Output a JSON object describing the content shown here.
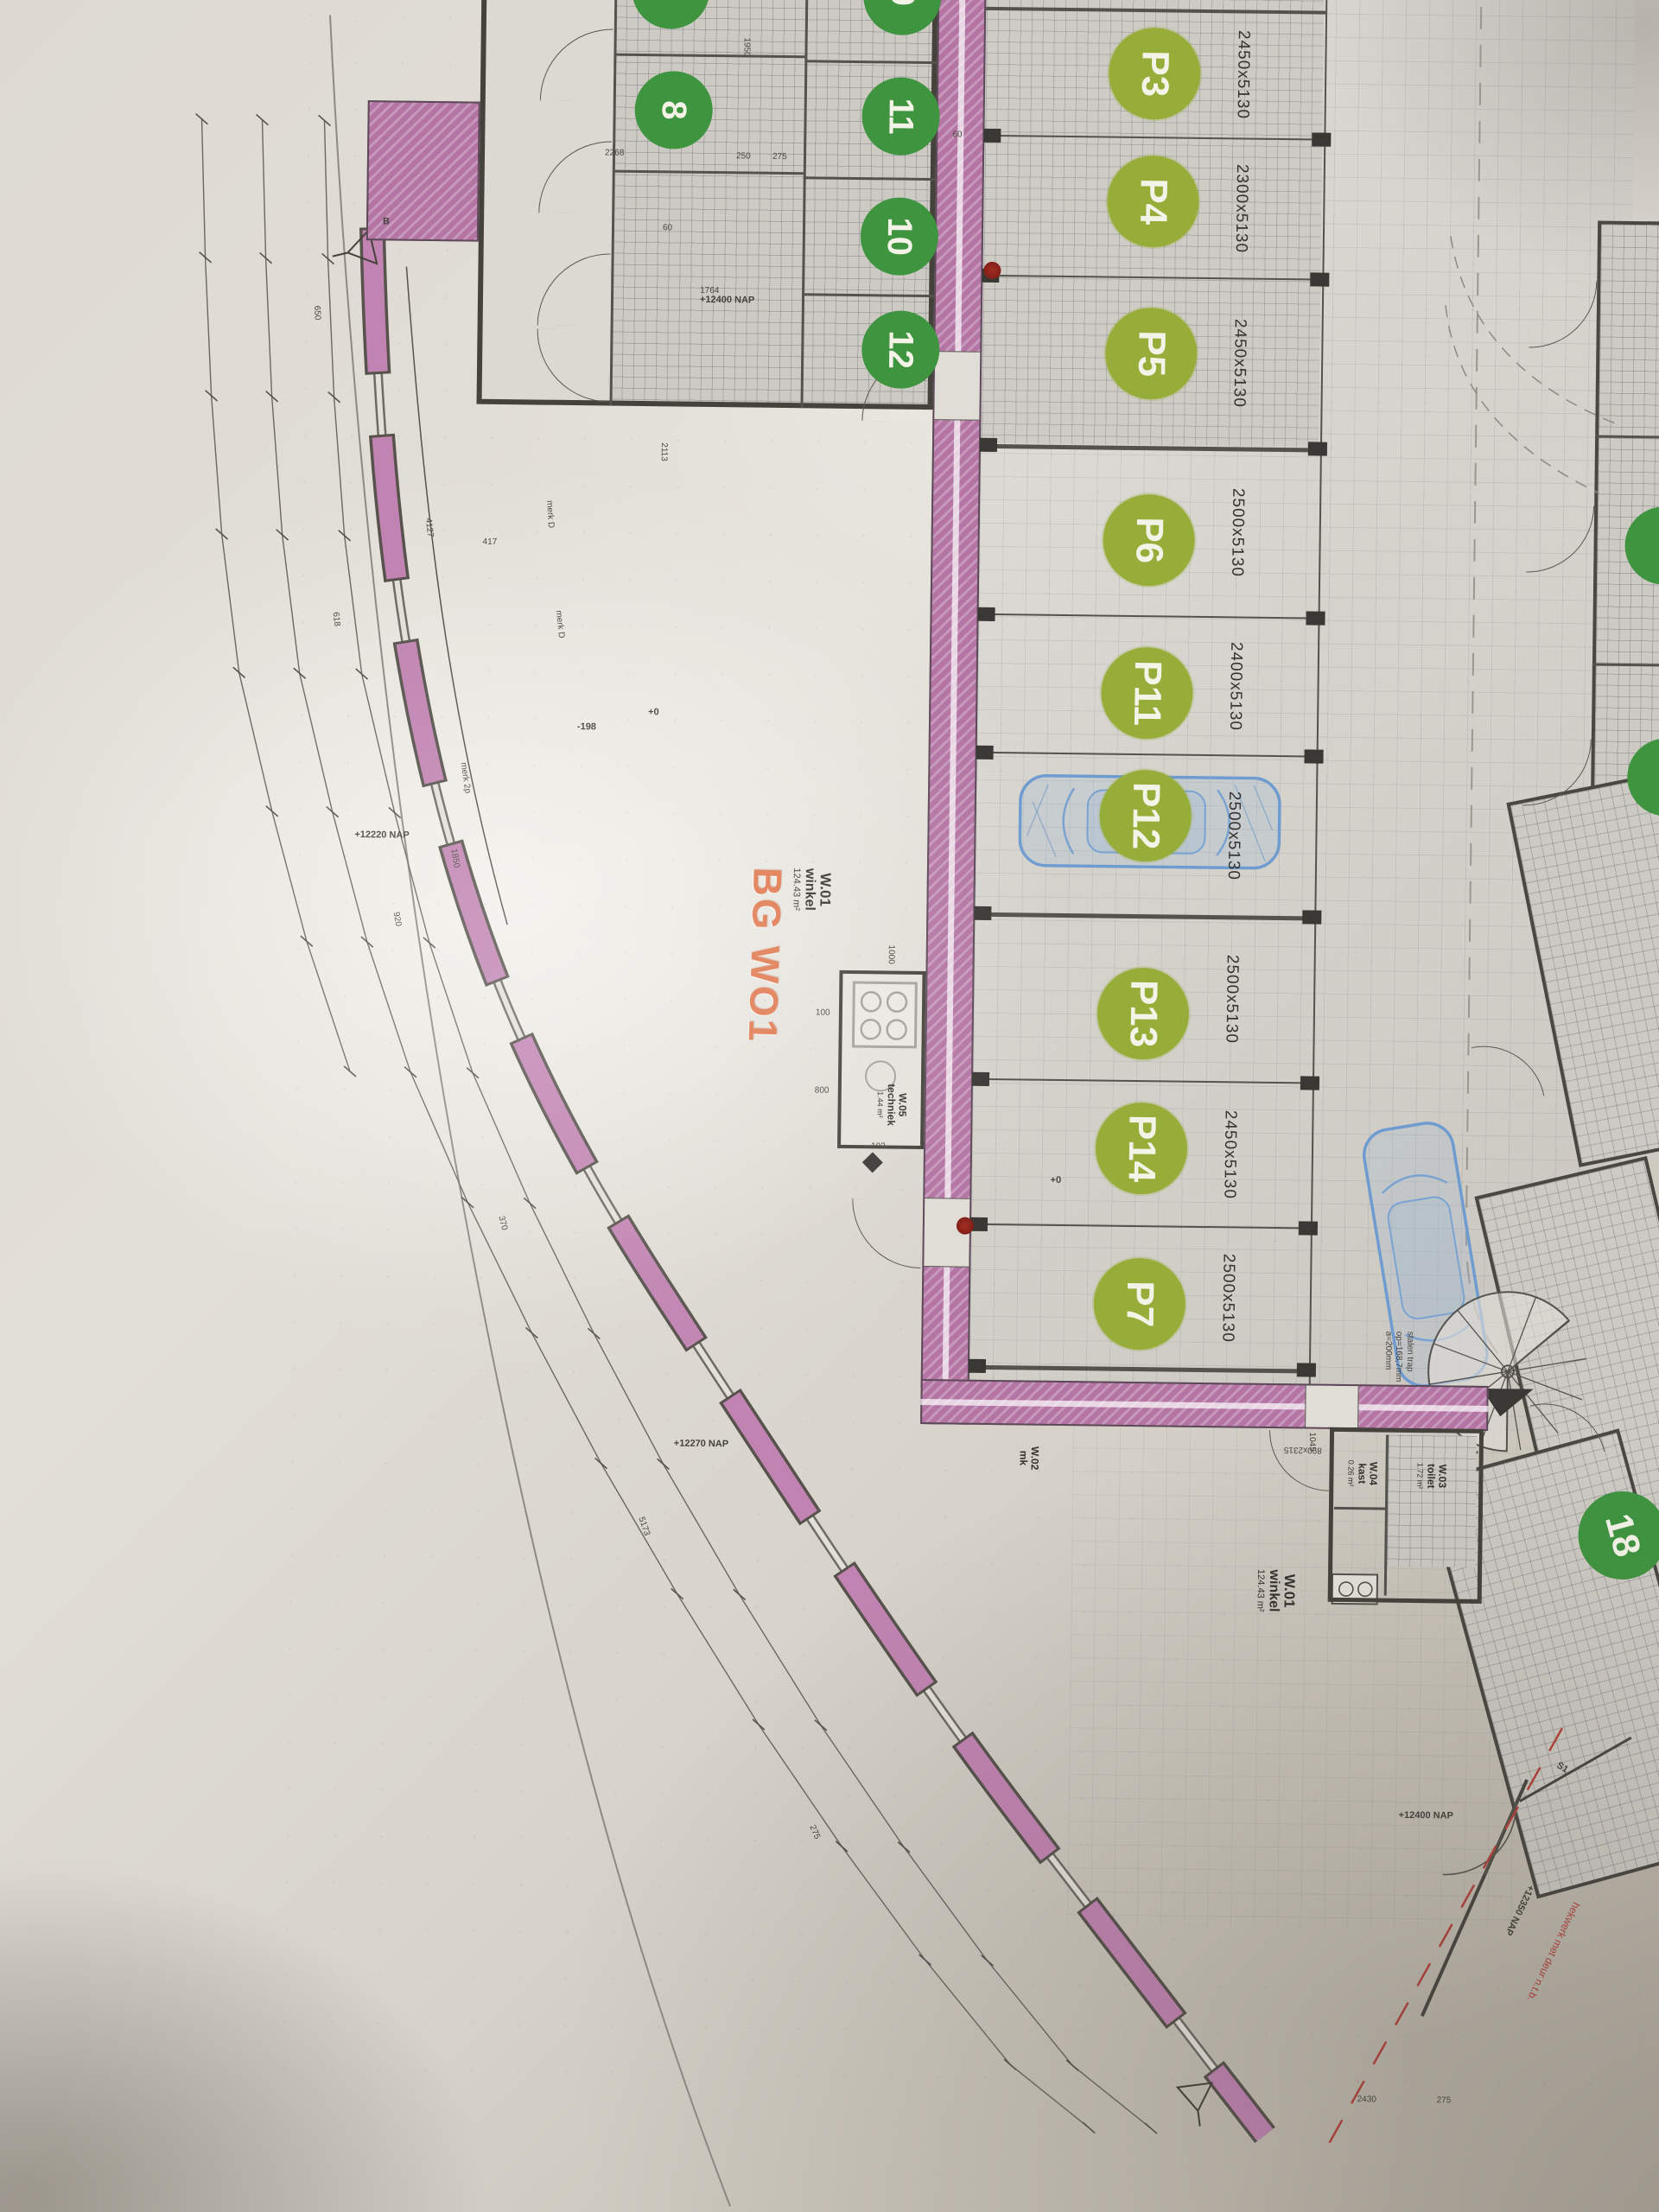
{
  "document": {
    "kind": "architectural floor plan photo",
    "stamp": "BG WO1"
  },
  "colors": {
    "parking_green": "#97ad39",
    "unit_green": "#3f9440",
    "wall_pink": "#b475a4",
    "stamp_orange": "#e0784e",
    "note_red": "#b5433c",
    "car_blue": "#7aa3d2"
  },
  "parking": {
    "spaces": [
      {
        "id": "P3",
        "size": "2450x5130"
      },
      {
        "id": "P4",
        "size": "2300x5130"
      },
      {
        "id": "P5",
        "size": "2450x5130"
      },
      {
        "id": "P6",
        "size": "2500x5130"
      },
      {
        "id": "P11",
        "size": "2400x5130"
      },
      {
        "id": "P12",
        "size": "2500x5130"
      },
      {
        "id": "P13",
        "size": "2500x5130"
      },
      {
        "id": "P14",
        "size": "2450x5130"
      },
      {
        "id": "P7",
        "size": "2500x5130"
      }
    ]
  },
  "units": {
    "numbers": [
      "9",
      "11",
      "10",
      "12",
      "7",
      "8",
      "18"
    ]
  },
  "rooms": {
    "winkel": {
      "id": "W.01",
      "name": "winkel",
      "area": "124.43 m²"
    },
    "techniek": {
      "id": "W.05",
      "name": "techniek",
      "area": "1.44 m²"
    },
    "toilet": {
      "id": "W.03",
      "name": "toilet",
      "area": "1.72 m²"
    },
    "kast": {
      "id": "W.04",
      "name": "kast",
      "area": "0.26 m²"
    },
    "mk": {
      "id": "W.02",
      "name": "mk"
    }
  },
  "levels": {
    "items": [
      {
        "text": "+12400 NAP"
      },
      {
        "text": "+12220 NAP"
      },
      {
        "text": "+12270 NAP"
      },
      {
        "text": "+12400 NAP"
      },
      {
        "text": "+12350 NAP"
      },
      {
        "text": "+0"
      },
      {
        "text": "-198"
      },
      {
        "text": "+0"
      }
    ]
  },
  "notes": {
    "fence": "hekwerk met deur n.t.b.",
    "stair1": "stalen trap",
    "stair2": "op=168,7mm",
    "stair3": "a=200mm",
    "merk_d": "merk D",
    "merk_2p": "merk 2p",
    "s1": "S1",
    "section_b": "B"
  },
  "dimensions": {
    "items": [
      {
        "text": "4127"
      },
      {
        "text": "1850"
      },
      {
        "text": "2113"
      },
      {
        "text": "1764"
      },
      {
        "text": "2268"
      },
      {
        "text": "250"
      },
      {
        "text": "275"
      },
      {
        "text": "1950"
      },
      {
        "text": "1045"
      },
      {
        "text": "890x2315"
      },
      {
        "text": "2430"
      },
      {
        "text": "275"
      },
      {
        "text": "100"
      },
      {
        "text": "800"
      },
      {
        "text": "1000"
      },
      {
        "text": "102"
      },
      {
        "text": "417"
      },
      {
        "text": "650"
      },
      {
        "text": "618"
      },
      {
        "text": "920"
      },
      {
        "text": "370"
      },
      {
        "text": "5173"
      },
      {
        "text": "275"
      },
      {
        "text": "60"
      },
      {
        "text": "60"
      }
    ]
  }
}
